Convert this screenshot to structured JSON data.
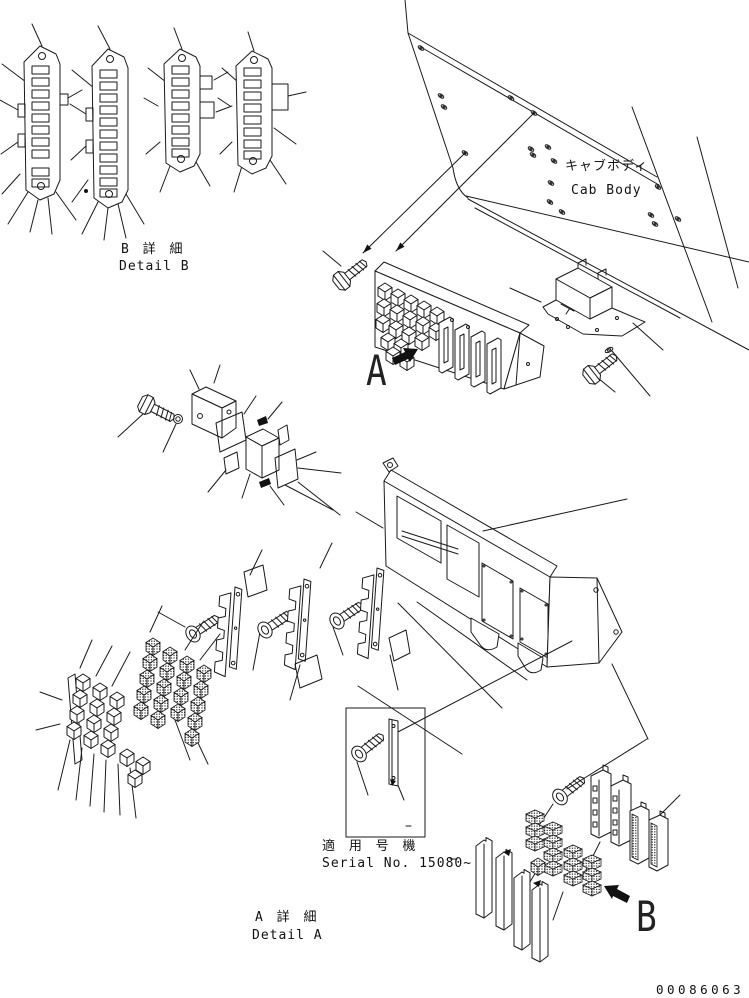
{
  "diagram": {
    "type": "exploded-parts-diagram",
    "labels": {
      "detail_b_jp": "B 詳 細",
      "detail_b_en": "Detail B",
      "cab_body_jp": "キャブボディ",
      "cab_body_en": "Cab Body",
      "serial_applicability_jp": "適 用 号 機",
      "serial_applicability_en": "Serial No. 15080~",
      "detail_a_jp": "A 詳 細",
      "detail_a_en": "Detail A",
      "view_arrow_a": "A",
      "view_arrow_b": "B",
      "drawing_number": "00086063"
    },
    "colors": {
      "line": "#1a1a1a",
      "background": "#ffffff"
    }
  }
}
